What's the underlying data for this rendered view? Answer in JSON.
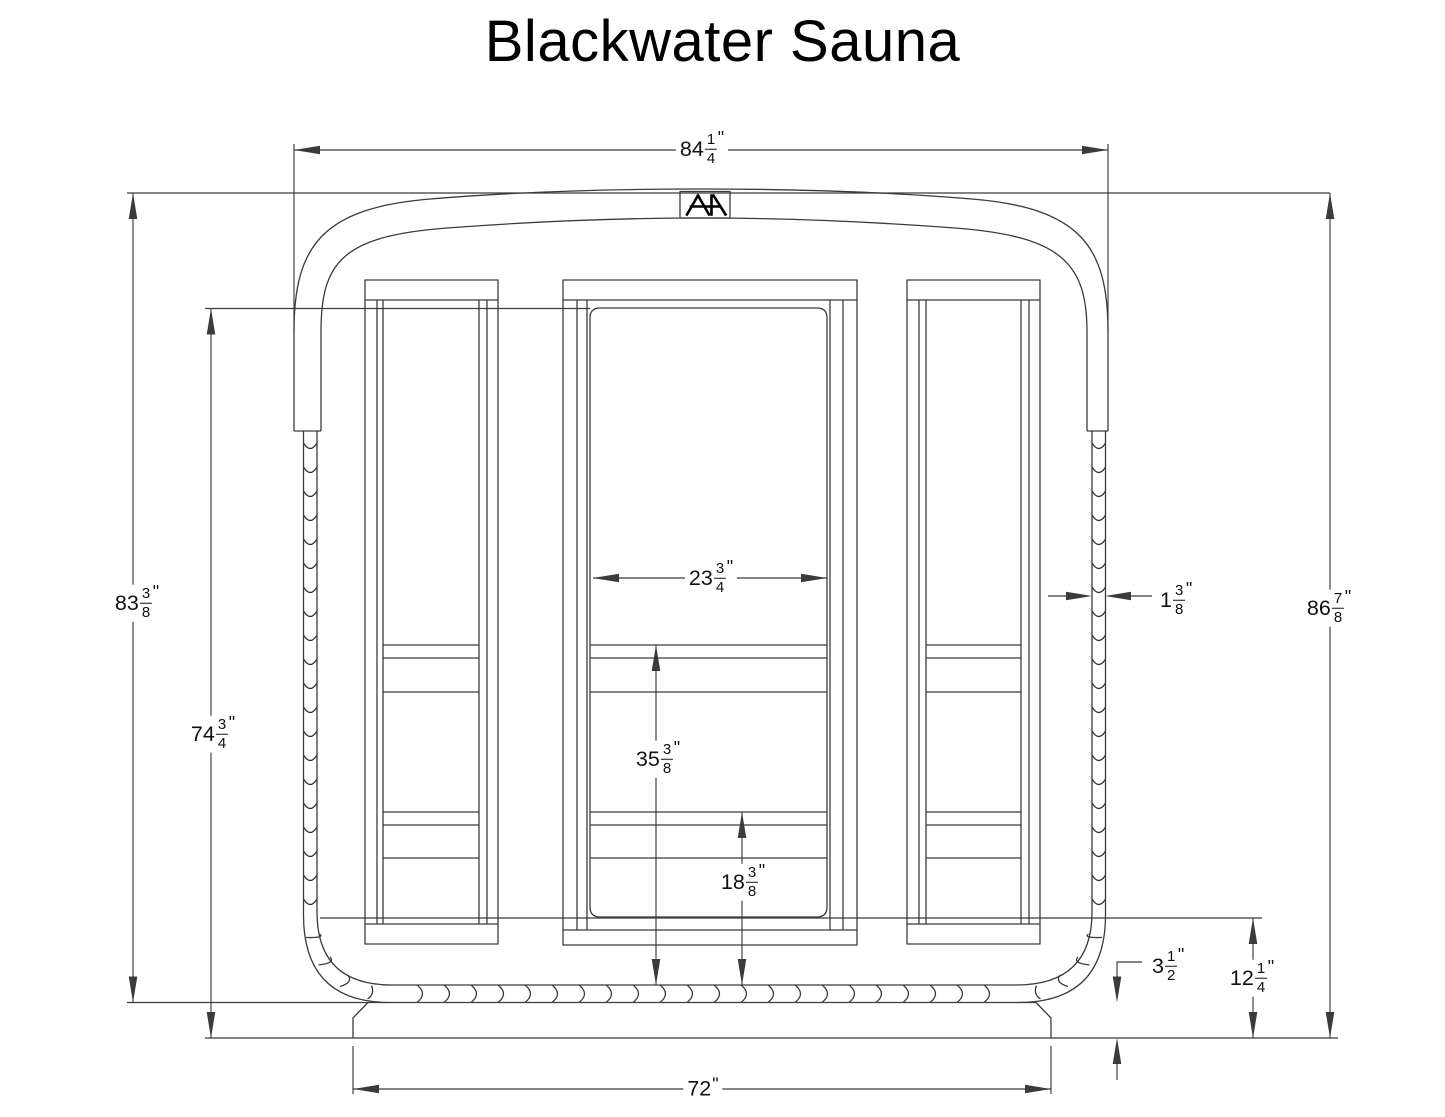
{
  "title": "Blackwater Sauna",
  "logo": {
    "monogram": "AH"
  },
  "colors": {
    "line": "#3b3b3b",
    "background": "#ffffff",
    "text": "#111111"
  },
  "dimensions": {
    "overall_width": {
      "whole": "84",
      "num": "1",
      "den": "4",
      "unit": "\""
    },
    "body_height": {
      "whole": "83",
      "num": "3",
      "den": "8",
      "unit": "\""
    },
    "door_top_height": {
      "whole": "74",
      "num": "3",
      "den": "4",
      "unit": "\""
    },
    "total_height": {
      "whole": "86",
      "num": "7",
      "den": "8",
      "unit": "\""
    },
    "door_glass_width": {
      "whole": "23",
      "num": "3",
      "den": "4",
      "unit": "\""
    },
    "wall_thickness": {
      "whole": "1",
      "num": "3",
      "den": "8",
      "unit": "\""
    },
    "upper_bench_height": {
      "whole": "35",
      "num": "3",
      "den": "8",
      "unit": "\""
    },
    "lower_bench_height": {
      "whole": "18",
      "num": "3",
      "den": "8",
      "unit": "\""
    },
    "base_height": {
      "whole": "3",
      "num": "1",
      "den": "2",
      "unit": "\""
    },
    "floor_height": {
      "whole": "12",
      "num": "1",
      "den": "4",
      "unit": "\""
    },
    "base_width": {
      "whole": "72",
      "unit": "\""
    }
  }
}
